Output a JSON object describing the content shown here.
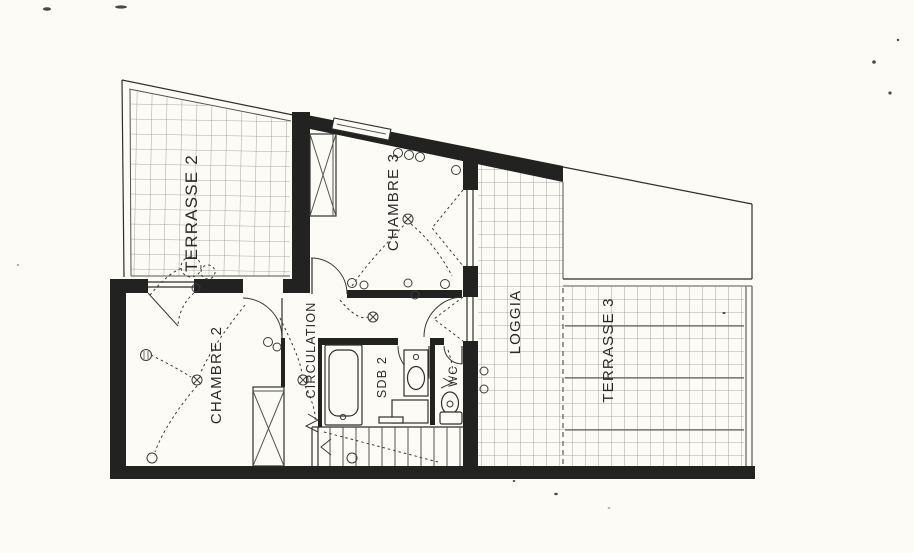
{
  "plan": {
    "type": "floor-plan",
    "rooms": {
      "terrasse2": {
        "label": "TERRASSE 2"
      },
      "chambre3": {
        "label": "CHAMBRE 3"
      },
      "loggia": {
        "label": "LOGGIA"
      },
      "terrasse3": {
        "label": "TERRASSE 3"
      },
      "chambre2": {
        "label": "CHAMBRE 2"
      },
      "circulation": {
        "label": "CIRCULATION"
      },
      "sdb2": {
        "label": "SDB 2"
      },
      "wc": {
        "label": "WC"
      }
    },
    "colors": {
      "paper": "#fcfbf6",
      "ink": "#222220",
      "line": "#2e2e2c",
      "tile": "#8f8f8a"
    }
  }
}
